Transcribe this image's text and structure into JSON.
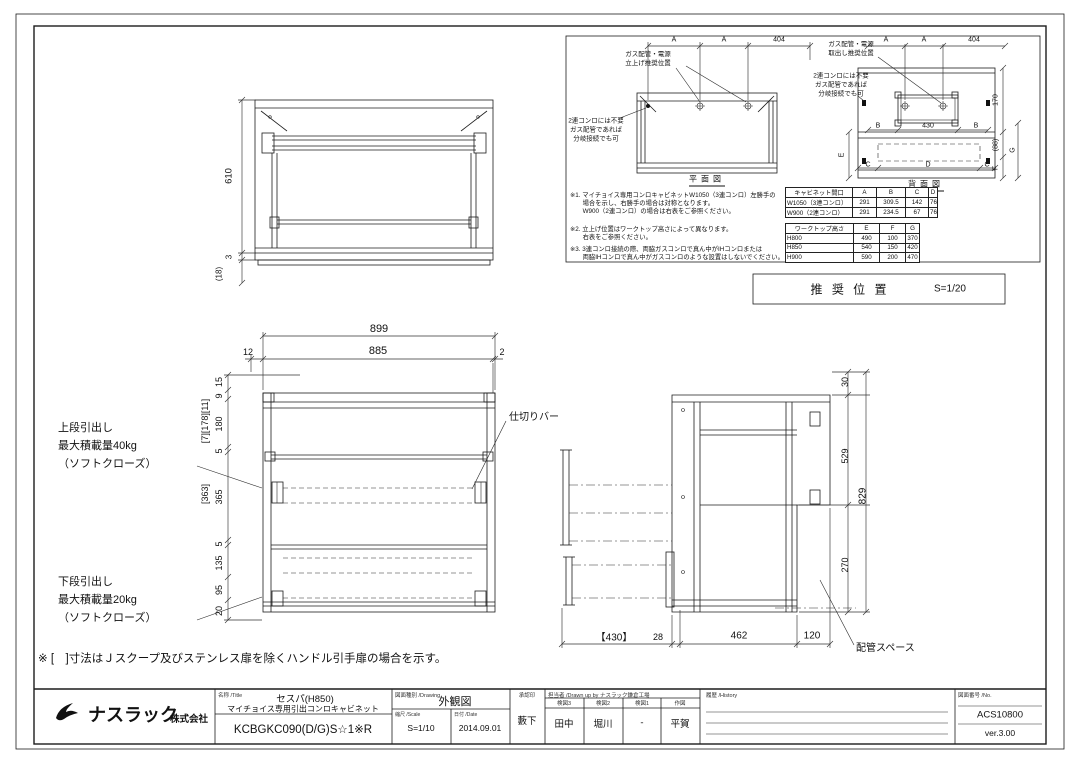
{
  "sheet": {
    "bottom_note": "※ [　]寸法はＪスクープ及びステンレス扉を除くハンドル引手扉の場合を示す。"
  },
  "carcass_view": {
    "dim_height": "610",
    "dim_bottom": "3",
    "dim_paren": "(18)"
  },
  "plan_section": {
    "plan": {
      "label": "平面図",
      "dims_top": [
        "A",
        "A",
        "404"
      ],
      "callout_top": "ガス配管・電源\n立上げ推奨位置",
      "callout_side": "2連コンロには不要\nガス配管であれば\n分岐接続でも可"
    },
    "rear": {
      "label": "背面図",
      "dims_top": [
        "A",
        "A",
        "404"
      ],
      "dims_mid": [
        "B",
        "430",
        "B"
      ],
      "dims_bottom": [
        "C",
        "D",
        "C"
      ],
      "dims_right": [
        "170",
        "(88)",
        "F",
        "G"
      ],
      "dim_left": "E",
      "callout_top": "ガス配管・電源\n取出し推奨位置",
      "callout_side": "2連コンロには不要\nガス配管であれば\n分岐接続でも可"
    },
    "notes": [
      "※1. マイチョイス専用コンロキャビネットW1050（3連コンロ）左勝手の\n　　場合を示し、右勝手の場合は対称となります。\n　　W900（2連コンロ）の場合は右表をご参照ください。",
      "※2. 立上げ位置はワークトップ高さによって異なります。\n　　右表をご参照ください。",
      "※3. 3連コンロ接続の際、両脇ガスコンロで真ん中がIHコンロまたは\n　　両脇IHコンロで真ん中がガスコンロのような設置はしないでください。"
    ],
    "table_opening": {
      "headers": [
        "キャビネット間口",
        "A",
        "B",
        "C",
        "D"
      ],
      "rows": [
        [
          "W1050（3連コンロ）",
          "291",
          "309.5",
          "142",
          "765"
        ],
        [
          "W900（2連コンロ）",
          "291",
          "234.5",
          "67",
          "765"
        ]
      ]
    },
    "table_worktop": {
      "headers": [
        "ワークトップ高さ",
        "E",
        "F",
        "G"
      ],
      "rows": [
        [
          "H800",
          "490",
          "100",
          "370"
        ],
        [
          "H850",
          "540",
          "150",
          "420"
        ],
        [
          "H900",
          "590",
          "200",
          "470"
        ]
      ]
    },
    "recommended_position": "推 奨 位 置",
    "recommended_scale": "S=1/20"
  },
  "front_view": {
    "dim_overall": "899",
    "dims_top": [
      "12",
      "885",
      "2"
    ],
    "dims_left": [
      "15",
      "9",
      "180",
      "5",
      "365",
      "5",
      "135",
      "95",
      "20"
    ],
    "dims_bracket_top": "[7][178][11]",
    "dims_bracket_mid": "[363]",
    "callout_divider": "仕切りバー",
    "callout_upper": "上段引出し\n最大積載量40kg\n（ソフトクローズ）",
    "callout_lower": "下段引出し\n最大積載量20kg\n（ソフトクローズ）"
  },
  "side_view": {
    "dims_right": [
      "30",
      "529",
      "270"
    ],
    "dim_total": "829",
    "dims_bottom": [
      "【430】",
      "28",
      "462",
      "120"
    ],
    "callout_pipe": "配管スペース"
  },
  "title_block": {
    "company_name": "ナスラック",
    "company_suffix": "株式会社",
    "name_label": "名称 /Title",
    "product_series": "セスパ(H850)",
    "product_name": "マイチョイス専用引出コンロキャビネット",
    "model_number": "KCBGKC090(D/G)S☆1※R",
    "drawing_type_label": "図面種別 /Drawing",
    "drawing_type": "外観図",
    "scale_label": "縮尺 /Scale",
    "scale_value": "S=1/10",
    "date_label": "日付 /Date",
    "date_value": "2014.09.01",
    "approval_label": "承認印",
    "approval_name": "藪下",
    "staff_label": "担当者 /Drawn up by ナスラック鎌倉工場",
    "staff_cols": [
      {
        "label": "検図3",
        "name": "田中"
      },
      {
        "label": "検図2",
        "name": "堀川"
      },
      {
        "label": "検図1",
        "name": "-"
      },
      {
        "label": "作図",
        "name": "平賀"
      }
    ],
    "history_label": "履歴 /History",
    "drawing_no_label": "図面番号 /No.",
    "drawing_no": "ACS10800",
    "version": "ver.3.00"
  }
}
